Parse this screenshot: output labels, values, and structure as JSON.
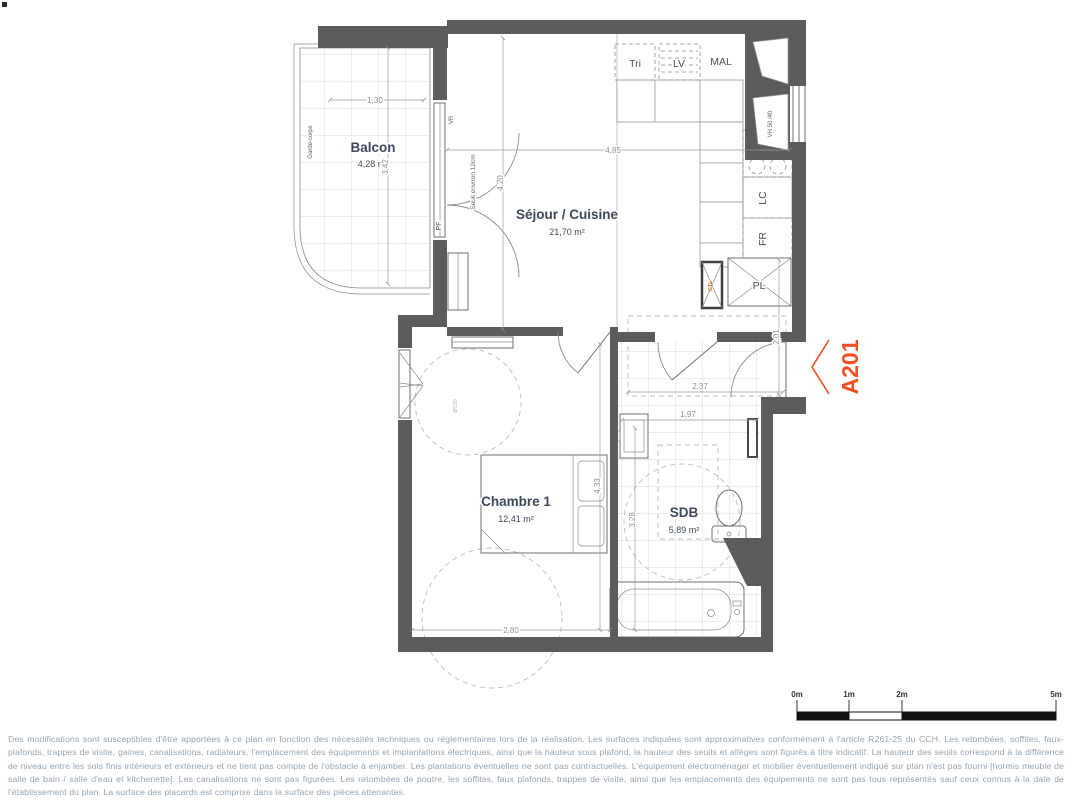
{
  "plan": {
    "unit": {
      "label": "A201",
      "color": "#F04E23"
    },
    "rooms": {
      "balcon": {
        "name": "Balcon",
        "area": "4,28 m²"
      },
      "sejour": {
        "name": "Séjour / Cuisine",
        "area": "21,70 m²"
      },
      "chambre": {
        "name": "Chambre 1",
        "area": "12,41 m²"
      },
      "sdb": {
        "name": "SDB",
        "area": "5,89 m²"
      }
    },
    "fixtures": {
      "tri": "Tri",
      "lv": "LV",
      "mal": "MAL",
      "lc": "LC",
      "fr": "FR",
      "pl": "PL",
      "gtl": "GTL",
      "vh": "VH 50 /40",
      "vr": "VR",
      "pf": "PF",
      "garde_corps": "Garde-corps",
      "seuil": "Seuil environ 12cm",
      "turning_circle": "Ø150"
    },
    "dimensions": {
      "balcon_width": "1,30",
      "balcon_height": "3,42",
      "sejour_width": "4,85",
      "sejour_height": "4,20",
      "hall_width": "2,37",
      "entry_height": "2,01",
      "sdb_width": "1,97",
      "sdb_height": "3,28",
      "chambre_height": "4,33",
      "chambre_width": "2,80"
    },
    "colors": {
      "wall": "#5c5c5c",
      "accent": "#F04E23",
      "room_label": "#3C4A5D"
    }
  },
  "scale_bar": {
    "ticks": [
      "0m",
      "1m",
      "2m",
      "5m"
    ]
  },
  "disclaimer": "Des modifications sont susceptibles d'être apportées à ce plan en fonction des nécessités techniques ou réglementaires lors de la réalisation. Les surfaces indiquées sont approximatives conformément à l'article R261-25 du CCH. Les retombées, soffites, faux-plafonds, trappes de visite, gaines, canalisations, radiateurs, l'emplacement des équipements et implantations électriques, ainsi que la hauteur sous plafond, la hauteur des seuils et allèges sont figurés à titre indicatif. La hauteur des seuils correspond à la différence de niveau entre les sols finis intérieurs et extérieurs et ne tient pas compte de l'obstacle à enjamber. Les plantations éventuelles ne sont pas contractuelles. L'équipement électroménager et mobilier éventuellement indiqué sur plan n'est pas fourni [hormis meuble de salle de bain / salle d'eau et kitchenette]. Les canalisations ne sont pas figurées. Les retombées de poutre, les soffites, faux plafonds, trappes de visite, ainsi que les emplacements des équipements ne sont pas tous représentés sauf ceux connus à la date de l'établissement du plan. La surface des placards est comprise dans la surface des pièces attenantes."
}
